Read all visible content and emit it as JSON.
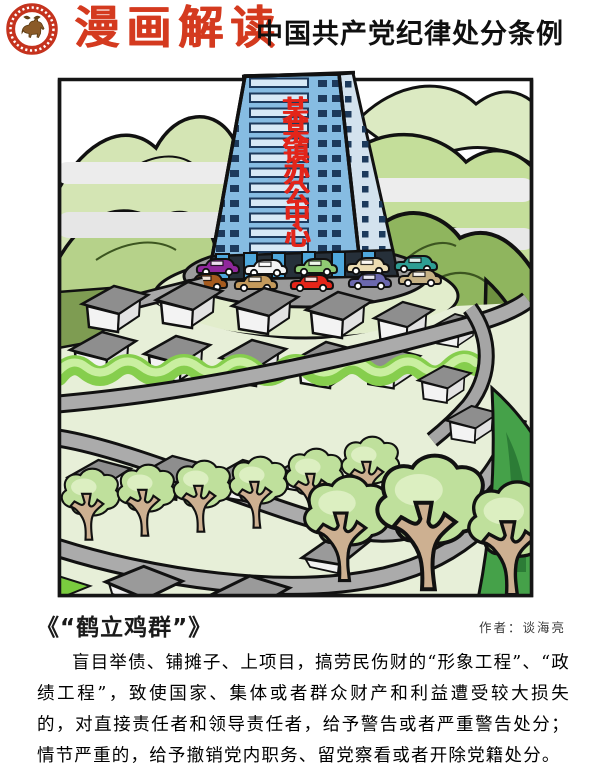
{
  "header": {
    "logo_icon": "bull-seal-icon",
    "title_red": "漫画解读",
    "title_black": "中国共产党纪律处分条例"
  },
  "cartoon": {
    "building_sign": "某某镇办公中心",
    "caption_title": "《“鹤立鸡群”》",
    "author": "作者：谈海亮",
    "cars": [
      {
        "color": "#90279C"
      },
      {
        "color": "#F4F4F4"
      },
      {
        "color": "#90CC74"
      },
      {
        "color": "#EBDCB2"
      },
      {
        "color": "#2E9E94"
      },
      {
        "color": "#A65B1E"
      },
      {
        "color": "#C49A5C"
      },
      {
        "color": "#E52519"
      },
      {
        "color": "#6B68AE"
      },
      {
        "color": "#C6B285"
      }
    ]
  },
  "body_text": "盲目举债、铺摊子、上项目，搞劳民伤财的“形象工程”、“政绩工程”，致使国家、集体或者群众财产和利益遭受较大损失的，对直接责任者和领导责任者，给予警告或者严重警告处分；情节严重的，给予撤销党内职务、留党察看或者开除党籍处分。",
  "colors": {
    "title_red": "#D43A1F",
    "sign_red": "#E3251A",
    "building_blue": "#86BCE2",
    "mountain_green": "#8FB55E",
    "plaza_grey": "#9C9C9C"
  }
}
